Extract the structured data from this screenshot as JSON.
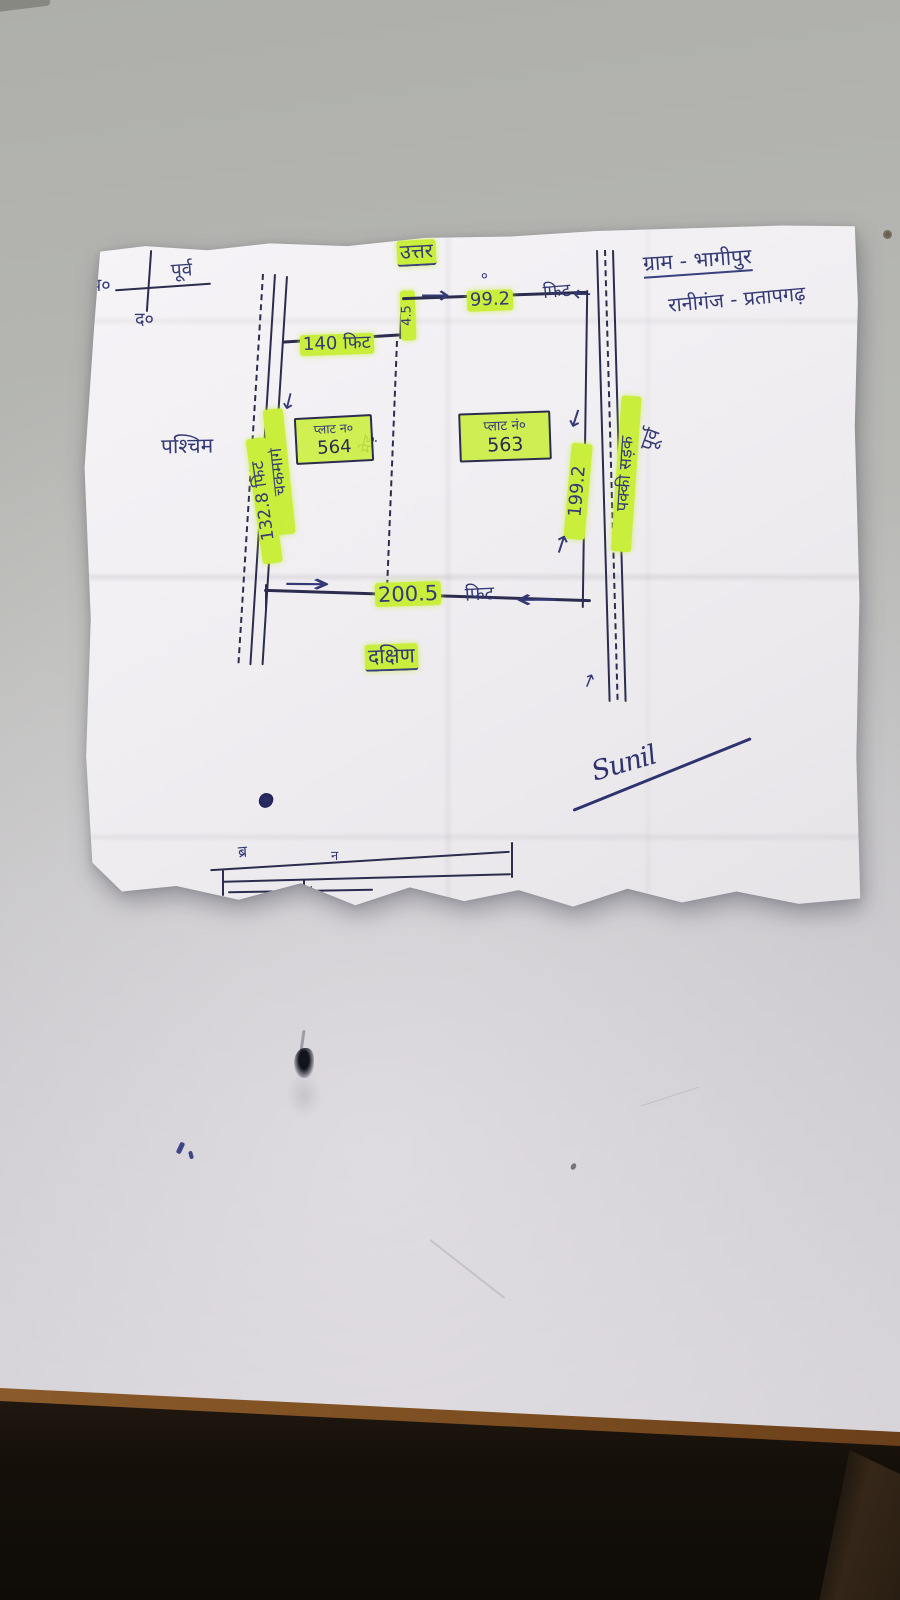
{
  "colors": {
    "highlighter": "#c9ee3c",
    "ink_blue": "#333a76",
    "line_dark": "#2c2d4e",
    "paper": "#f1eff2",
    "desk": "#b8b9b5",
    "desk_edge_brown": "#7d4f24",
    "desk_front_dark": "#15100b"
  },
  "header": {
    "village": "ग्राम - भागीपुर",
    "tehsil": "रानीगंज - प्रतापगढ़"
  },
  "compass": {
    "north": "उ०",
    "south": "द०",
    "west": "प०",
    "east": "पूर्व"
  },
  "directions": {
    "north": "उत्तर",
    "south": "दक्षिण",
    "west": "पश्चिम",
    "east": "पूर्व"
  },
  "plots": {
    "left": {
      "label": "प्लाट न०",
      "number": "564"
    },
    "right": {
      "label": "प्लाट नं०",
      "number": "563"
    }
  },
  "measurements": {
    "north_left": {
      "value": "140",
      "unit": "फिट"
    },
    "north_step": "4.5",
    "north_right": {
      "value": "99.2",
      "unit": "फिट"
    },
    "west_road_name": "चकमार्ग",
    "west_road_value": "132.8 फिट",
    "east_value": "199.2",
    "south": {
      "value": "200.5",
      "unit": "फिट"
    }
  },
  "labels": {
    "east_road": "पक्की सड़क",
    "divider": "मेड़",
    "stray_mark": "०"
  },
  "signature": {
    "name": "Sunil"
  },
  "fragment": {
    "char1": "ब्र",
    "char2": "न",
    "char3": "H"
  },
  "glyphs": {
    "arrow_right": "→",
    "arrow_left": "←",
    "arrow_down": "↓",
    "arrow_up": "↑"
  }
}
